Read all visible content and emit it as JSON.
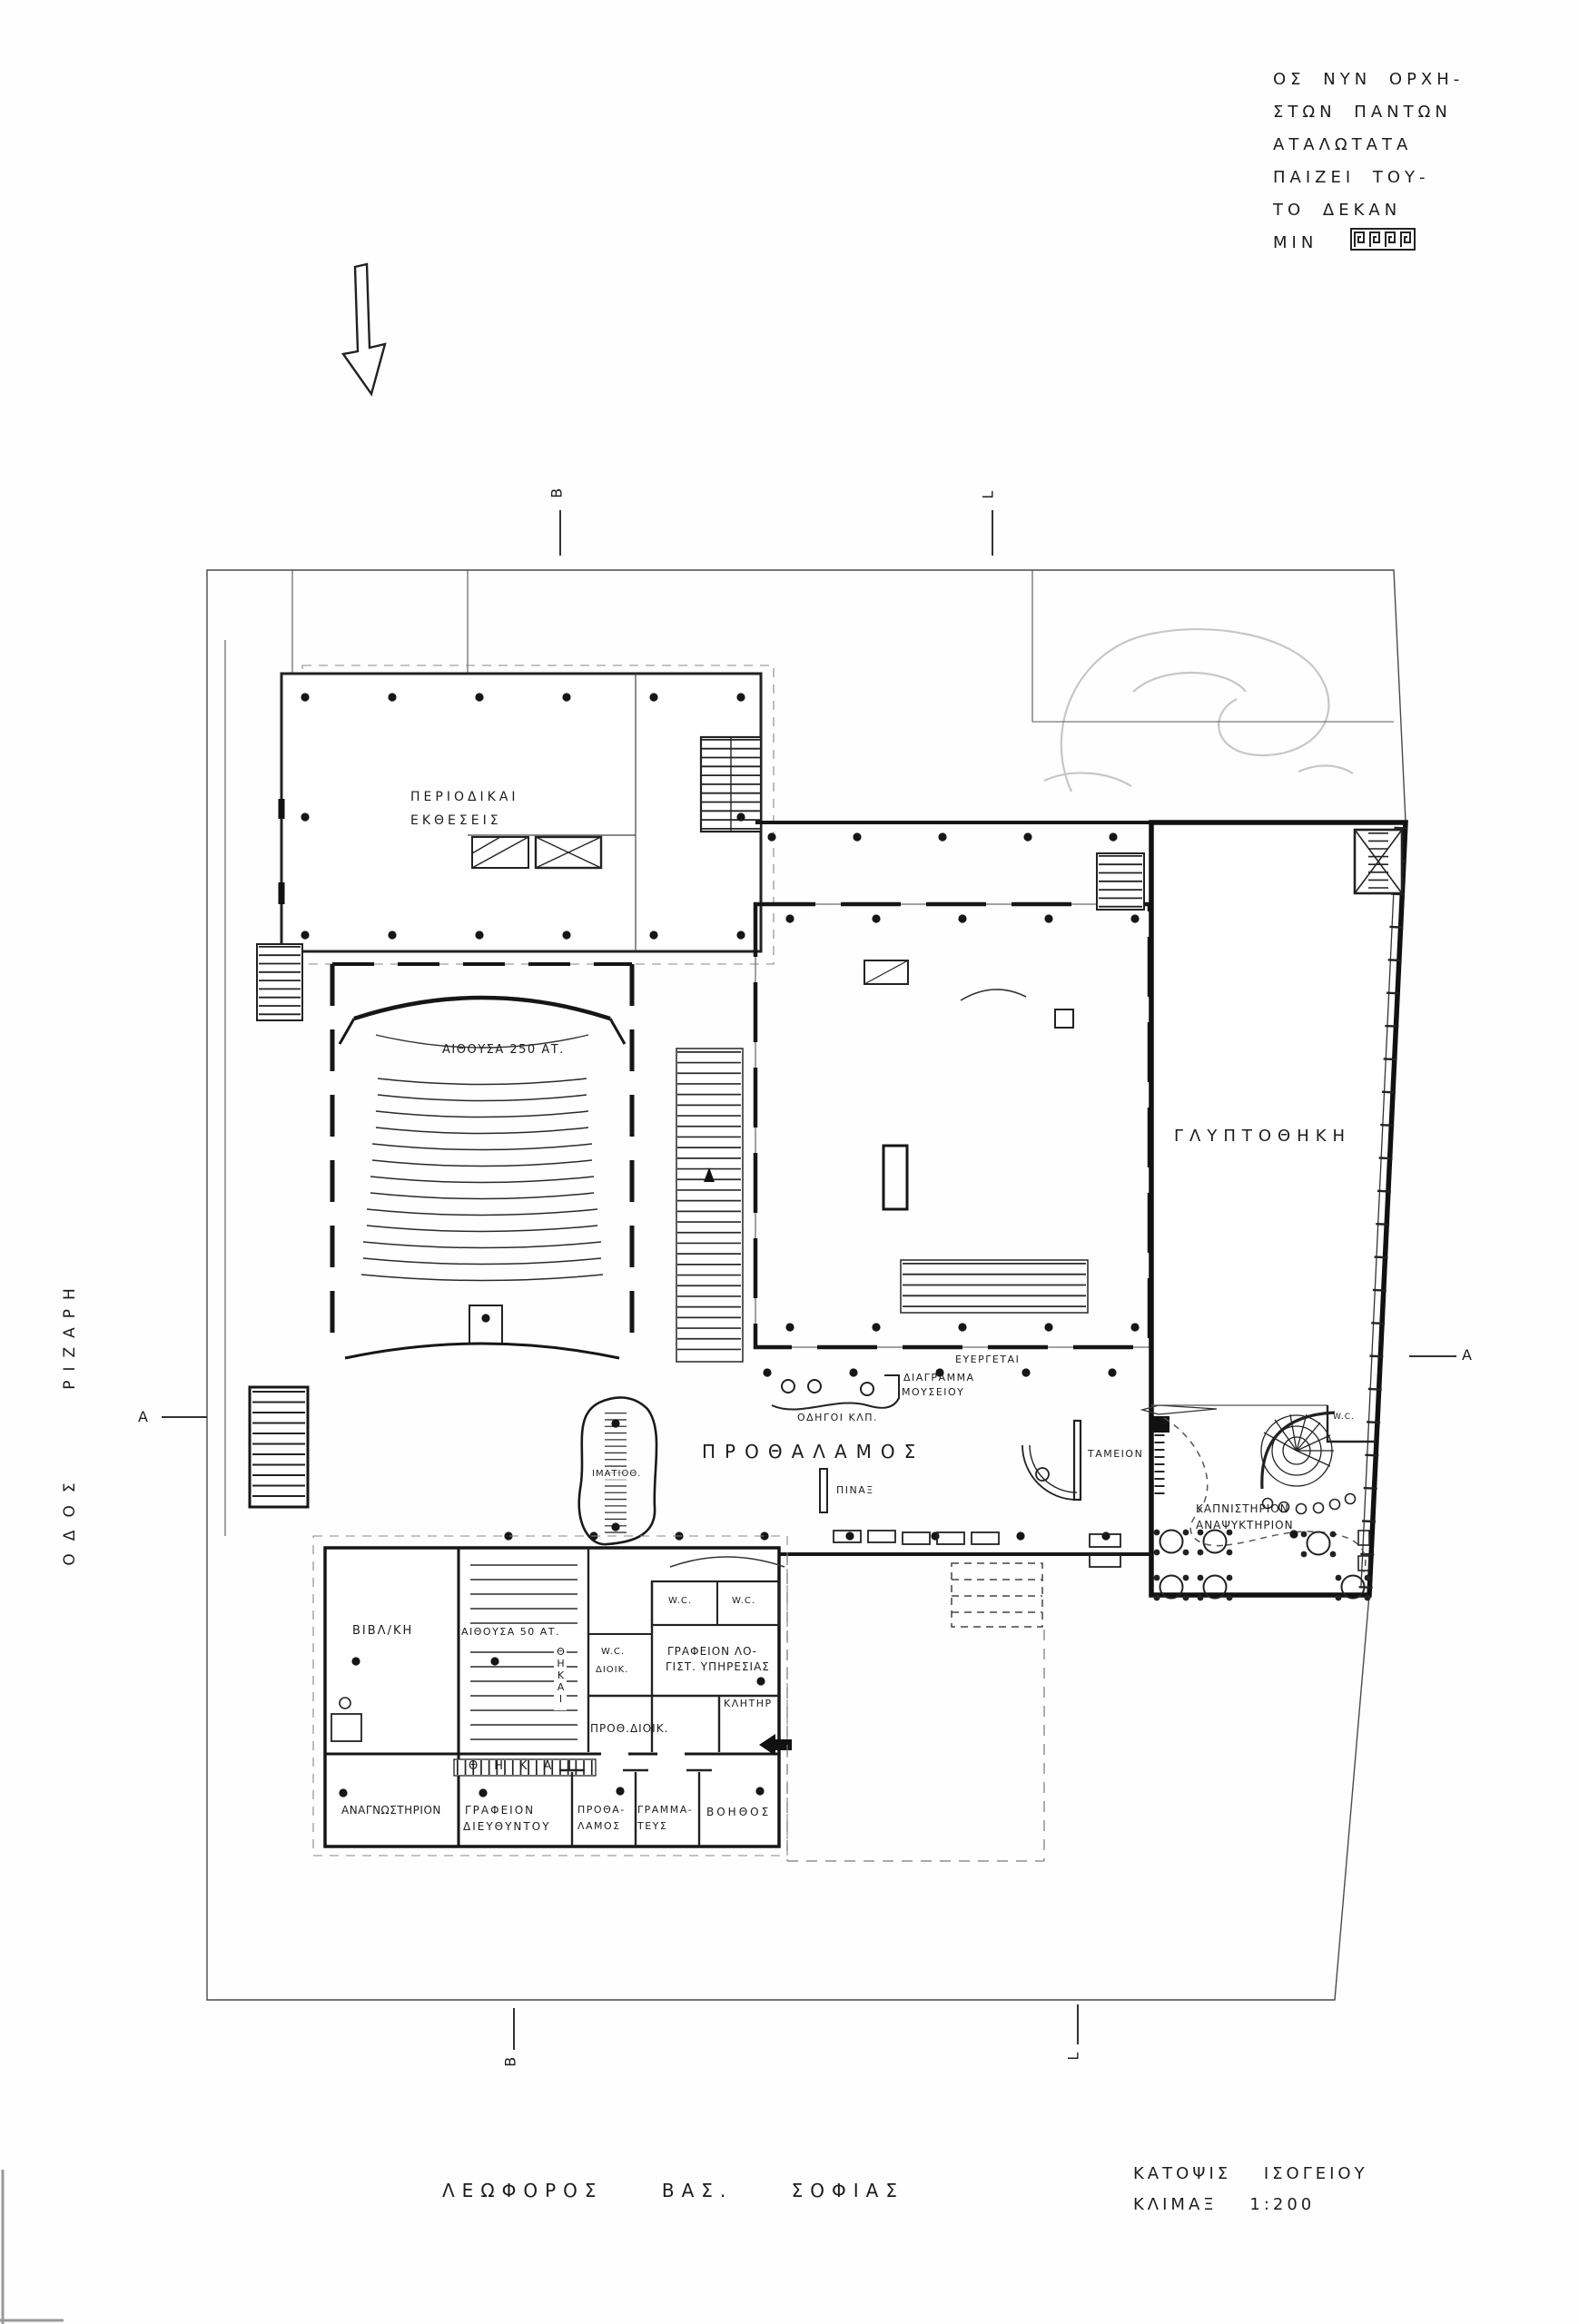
{
  "inscription": {
    "lines": [
      "ΟΣ ΝΥΝ ΟΡΧΗ-",
      "ΣΤΩΝ ΠΑΝΤΩΝ",
      "ΑΤΑΛΩΤΑΤΑ",
      "ΠΑΙΖΕΙ ΤΟΥ-",
      "ΤΟ ΔΕΚΑΝ",
      "ΜΙΝ"
    ]
  },
  "site": {
    "street_left_word1": "ΟΔΟΣ",
    "street_left_word2": "ΡΙΖΑΡΗ",
    "street_bottom": "ΛΕΩΦΟΡΟΣ ΒΑΣ. ΣΟΦΙΑΣ"
  },
  "title_block": {
    "line1": "ΚΑΤΟΨΙΣ ΙΣΟΓΕΙΟΥ",
    "line2": "ΚΛΙΜΑΞ 1:200"
  },
  "section_markers": {
    "b": "Β",
    "l": "L",
    "a": "Α"
  },
  "rooms": {
    "periodicals_line1": "ΠΕΡΙΟΔΙΚΑΙ",
    "periodicals_line2": "ΕΚΘΕΣΕΙΣ",
    "auditorium": "ΑΙΘΟΥΣΑ 250 ΑΤ.",
    "sculpture_gallery": "ΓΛΥΠΤΟΘΗΚΗ",
    "lobby": "ΠΡΟΘΑΛΑΜΟΣ",
    "board": "ΠΙΝΑΞ",
    "cloakroom": "ΙΜΑΤΙΟΘ.",
    "cashier": "ΤΑΜΕΙΟΝ",
    "smoking_line1": "ΚΑΠΝΙΣΤΗΡΙΟΝ",
    "smoking_line2": "ΑΝΑΨΥΚΤΗΡΙΟΝ",
    "diagram_line1": "ΔΙΑΓΡΑΜΜΑ",
    "diagram_line2": "ΜΟΥΣΕΙΟΥ",
    "guides": "ΟΔΗΓΟΙ ΚΛΠ.",
    "benefactors": "ΕΥΕΡΓΕΤΑΙ",
    "wc": "W.C.",
    "wc_admin": "ΔΙΟΙΚ.",
    "library": "ΒΙΒΛ/ΚΗ",
    "hall_50": "ΑΙΘΟΥΣΑ 50 ΑΤ.",
    "accounting_line1": "ΓΡΑΦΕΙΟΝ ΛΟ-",
    "accounting_line2": "ΓΙΣΤ. ΥΠΗΡΕΣΙΑΣ",
    "usher": "ΚΛΗΤΗΡ",
    "admin_hall": "ΠΡΟΘ.ΔΙΟΙΚ.",
    "cases_band": "ΘΗΚΑΙ",
    "cases_vertical": "ΘΗΚΑΙ",
    "reading_room": "ΑΝΑΓΝΩΣΤΗΡΙΟΝ",
    "director_line1": "ΓΡΑΦΕΙΟΝ",
    "director_line2": "ΔΙΕΥΘΥΝΤΟΥ",
    "anteroom_line1": "ΠΡΟΘΑ-",
    "anteroom_line2": "ΛΑΜΟΣ",
    "secretary_line1": "ΓΡΑΜΜΑ-",
    "secretary_line2": "ΤΕΥΣ",
    "assistant": "ΒΟΗΘΟΣ"
  }
}
